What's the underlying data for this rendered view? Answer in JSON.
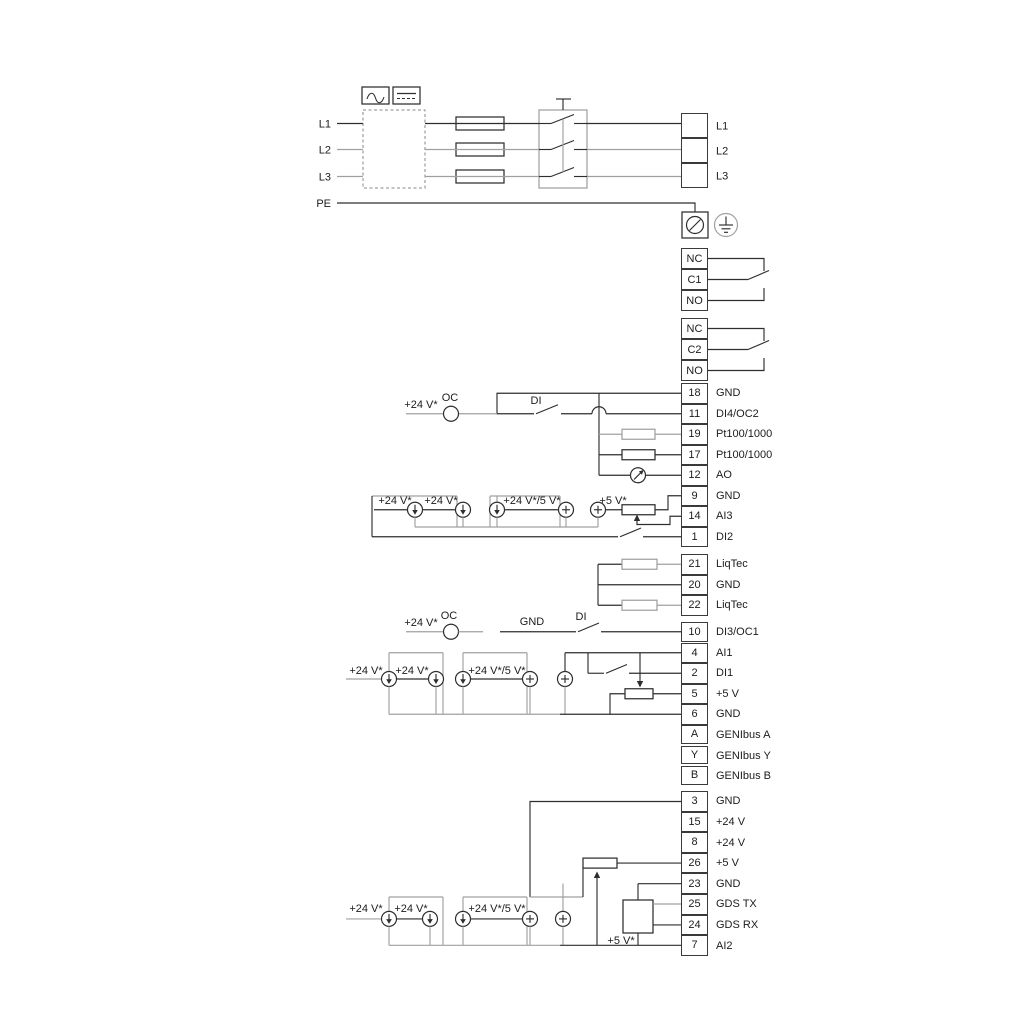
{
  "labels": {
    "plus24": "+24 V*",
    "plus24or5": "+24 V*/5 V*",
    "plus5": "+5 V*",
    "oc": "OC",
    "di": "DI",
    "gnd": "GND"
  },
  "power_input": {
    "left_labels": [
      "L1",
      "L2",
      "L3",
      "PE"
    ],
    "output_labels": [
      "L1",
      "L2",
      "L3"
    ]
  },
  "terminal_groups": [
    {
      "name": "relay-output-1",
      "rows": [
        {
          "id": "NC",
          "label": ""
        },
        {
          "id": "C1",
          "label": ""
        },
        {
          "id": "NO",
          "label": ""
        }
      ]
    },
    {
      "name": "relay-output-2",
      "rows": [
        {
          "id": "NC",
          "label": ""
        },
        {
          "id": "C2",
          "label": ""
        },
        {
          "id": "NO",
          "label": ""
        }
      ]
    },
    {
      "name": "io-block-1",
      "rows": [
        {
          "id": "18",
          "label": "GND"
        },
        {
          "id": "11",
          "label": "DI4/OC2"
        },
        {
          "id": "19",
          "label": "Pt100/1000"
        },
        {
          "id": "17",
          "label": "Pt100/1000"
        },
        {
          "id": "12",
          "label": "AO"
        },
        {
          "id": "9",
          "label": "GND"
        },
        {
          "id": "14",
          "label": "AI3"
        },
        {
          "id": "1",
          "label": "DI2"
        }
      ]
    },
    {
      "name": "liqtec-block",
      "rows": [
        {
          "id": "21",
          "label": "LiqTec"
        },
        {
          "id": "20",
          "label": "GND"
        },
        {
          "id": "22",
          "label": "LiqTec"
        }
      ]
    },
    {
      "name": "di3-block",
      "rows": [
        {
          "id": "10",
          "label": "DI3/OC1"
        }
      ]
    },
    {
      "name": "io-block-2",
      "rows": [
        {
          "id": "4",
          "label": "AI1"
        },
        {
          "id": "2",
          "label": "DI1"
        },
        {
          "id": "5",
          "label": "+5 V"
        },
        {
          "id": "6",
          "label": "GND"
        }
      ]
    },
    {
      "name": "genibus-block",
      "rows": [
        {
          "id": "A",
          "label": "GENIbus A"
        },
        {
          "id": "Y",
          "label": "GENIbus Y"
        },
        {
          "id": "B",
          "label": "GENIbus B"
        }
      ]
    },
    {
      "name": "io-block-3",
      "rows": [
        {
          "id": "3",
          "label": "GND"
        },
        {
          "id": "15",
          "label": "+24 V"
        },
        {
          "id": "8",
          "label": "+24 V"
        },
        {
          "id": "26",
          "label": "+5 V"
        },
        {
          "id": "23",
          "label": "GND"
        },
        {
          "id": "25",
          "label": "GDS TX"
        },
        {
          "id": "24",
          "label": "GDS RX"
        },
        {
          "id": "7",
          "label": "AI2"
        }
      ]
    }
  ],
  "colors": {
    "wire": "#2e2e2e",
    "wire_grey": "#a0a0a0",
    "text": "#1c1c1c",
    "background": "#ffffff"
  }
}
